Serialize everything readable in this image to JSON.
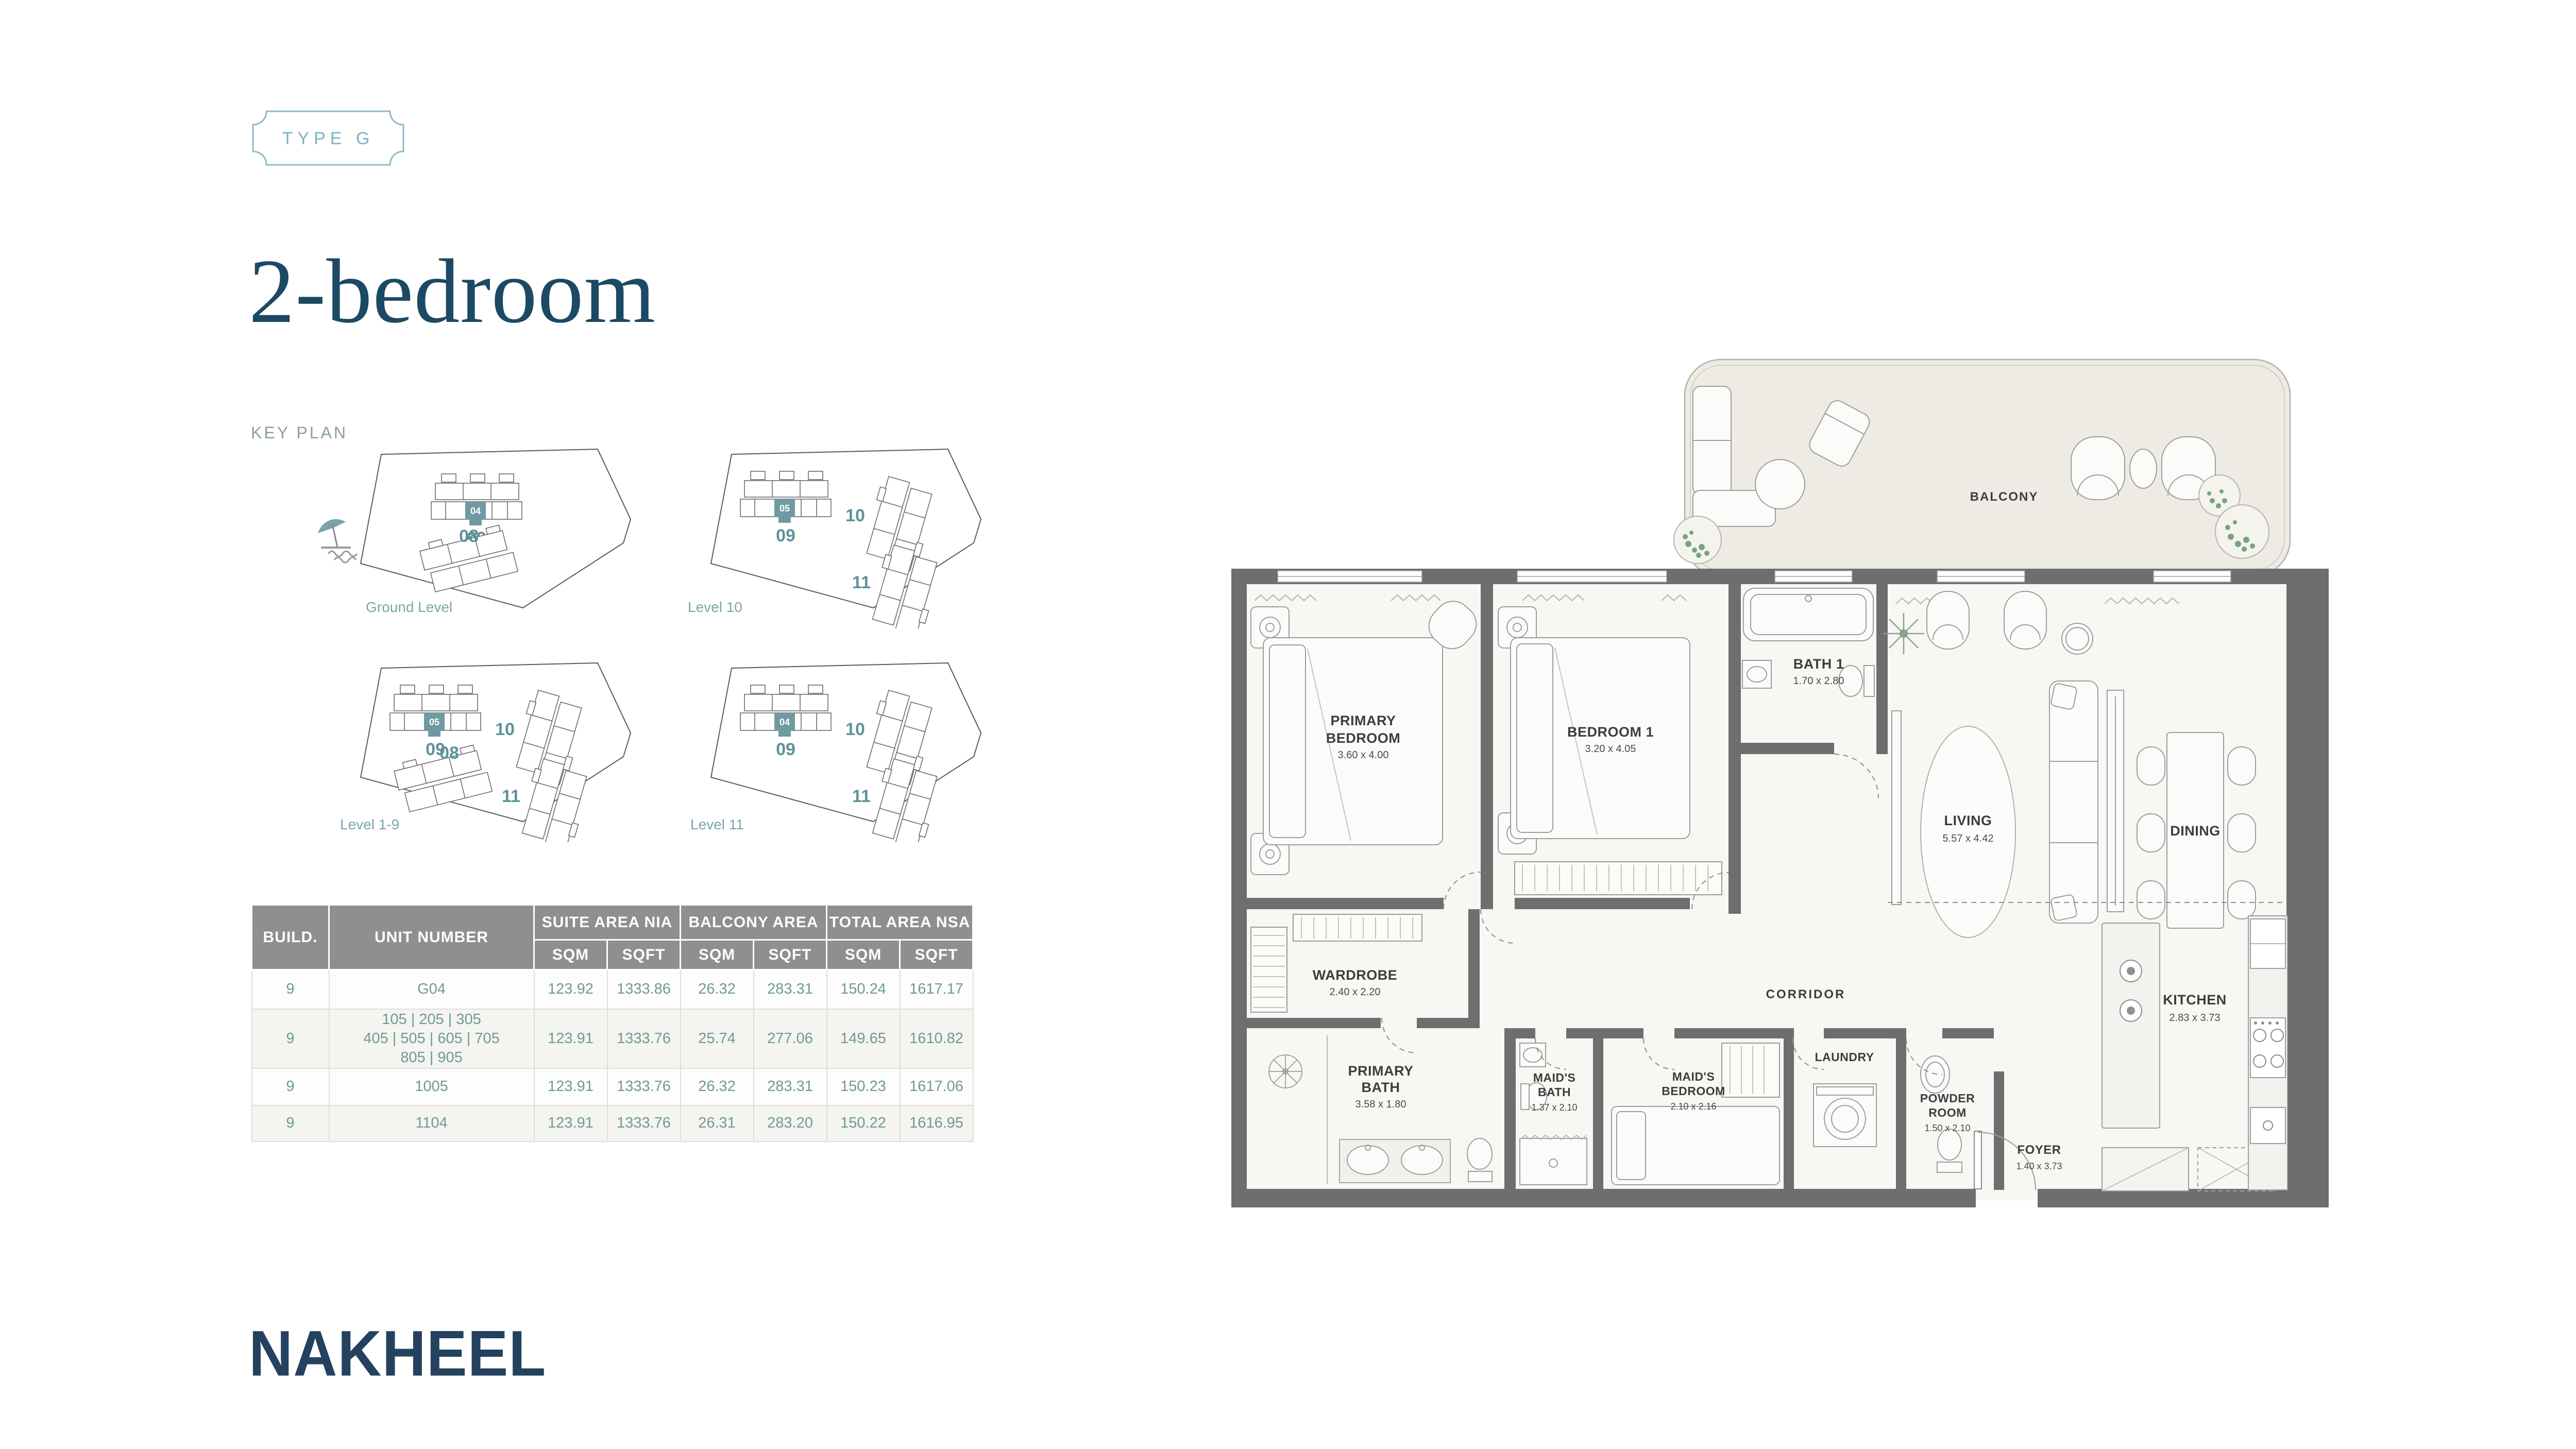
{
  "badge": {
    "label": "TYPE G"
  },
  "title": "2-bedroom",
  "key_plan": {
    "heading": "KEY PLAN",
    "plans": [
      {
        "label": "Ground Level",
        "unit": "04",
        "n09": "09",
        "n08": "08"
      },
      {
        "label": "Level 10",
        "unit": "05",
        "n09": "09",
        "n10": "10",
        "n11": "11"
      },
      {
        "label": "Level 1-9",
        "unit": "05",
        "n09": "09",
        "n10": "10",
        "n08": "08",
        "n11": "11"
      },
      {
        "label": "Level 11",
        "unit": "04",
        "n09": "09",
        "n10": "10",
        "n11": "11"
      }
    ]
  },
  "table": {
    "columns": {
      "build": "BUILD.",
      "unit": "UNIT NUMBER",
      "suite": "SUITE AREA NIA",
      "balcony": "BALCONY AREA",
      "total": "TOTAL AREA NSA",
      "sqm": "SQM",
      "sqft": "SQFT"
    },
    "rows": [
      {
        "build": "9",
        "unit_lines": [
          "G04"
        ],
        "suite_sqm": "123.92",
        "suite_sqft": "1333.86",
        "balcony_sqm": "26.32",
        "balcony_sqft": "283.31",
        "total_sqm": "150.24",
        "total_sqft": "1617.17"
      },
      {
        "build": "9",
        "unit_lines": [
          "105 | 205 | 305",
          "405 | 505 | 605 | 705",
          "805 | 905"
        ],
        "suite_sqm": "123.91",
        "suite_sqft": "1333.76",
        "balcony_sqm": "25.74",
        "balcony_sqft": "277.06",
        "total_sqm": "149.65",
        "total_sqft": "1610.82"
      },
      {
        "build": "9",
        "unit_lines": [
          "1005"
        ],
        "suite_sqm": "123.91",
        "suite_sqft": "1333.76",
        "balcony_sqm": "26.32",
        "balcony_sqft": "283.31",
        "total_sqm": "150.23",
        "total_sqft": "1617.06"
      },
      {
        "build": "9",
        "unit_lines": [
          "1104"
        ],
        "suite_sqm": "123.91",
        "suite_sqft": "1333.76",
        "balcony_sqm": "26.31",
        "balcony_sqft": "283.20",
        "total_sqm": "150.22",
        "total_sqft": "1616.95"
      }
    ]
  },
  "floor_plan": {
    "rooms": {
      "balcony": {
        "line1": "BALCONY"
      },
      "primary_bedroom": {
        "line1": "PRIMARY",
        "line2": "BEDROOM",
        "dim": "3.60 x 4.00"
      },
      "bedroom1": {
        "line1": "BEDROOM 1",
        "dim": "3.20 x 4.05"
      },
      "bath1": {
        "line1": "BATH 1",
        "dim": "1.70 x 2.80"
      },
      "living": {
        "line1": "LIVING",
        "dim": "5.57 x 4.42"
      },
      "dining": {
        "line1": "DINING"
      },
      "wardrobe": {
        "line1": "WARDROBE",
        "dim": "2.40 x 2.20"
      },
      "corridor": {
        "line1": "CORRIDOR"
      },
      "kitchen": {
        "line1": "KITCHEN",
        "dim": "2.83 x 3.73"
      },
      "primary_bath": {
        "line1": "PRIMARY",
        "line2": "BATH",
        "dim": "3.58 x 1.80"
      },
      "maids_bath": {
        "line1": "MAID'S",
        "line2": "BATH",
        "dim": "1.37 x 2.10"
      },
      "maids_bedroom": {
        "line1": "MAID'S",
        "line2": "BEDROOM",
        "dim": "2.10 x 2.16"
      },
      "laundry": {
        "line1": "LAUNDRY"
      },
      "powder_room": {
        "line1": "POWDER",
        "line2": "ROOM",
        "dim": "1.50 x 2.10"
      },
      "foyer": {
        "line1": "FOYER",
        "dim": "1.40 x 3.73"
      }
    }
  },
  "logo": {
    "text": "NAKHEEL"
  },
  "colors": {
    "accent_teal": "#5f929b",
    "highlight_teal": "#6f9aa2",
    "table_value": "#6e9a94",
    "header_gray": "#8f8f8f",
    "title_navy": "#1c4964",
    "badge_blue": "#85b7c6",
    "logo_navy": "#24415f",
    "wall_gray": "#6e6e6e",
    "balcony_fill": "#edebe4"
  }
}
